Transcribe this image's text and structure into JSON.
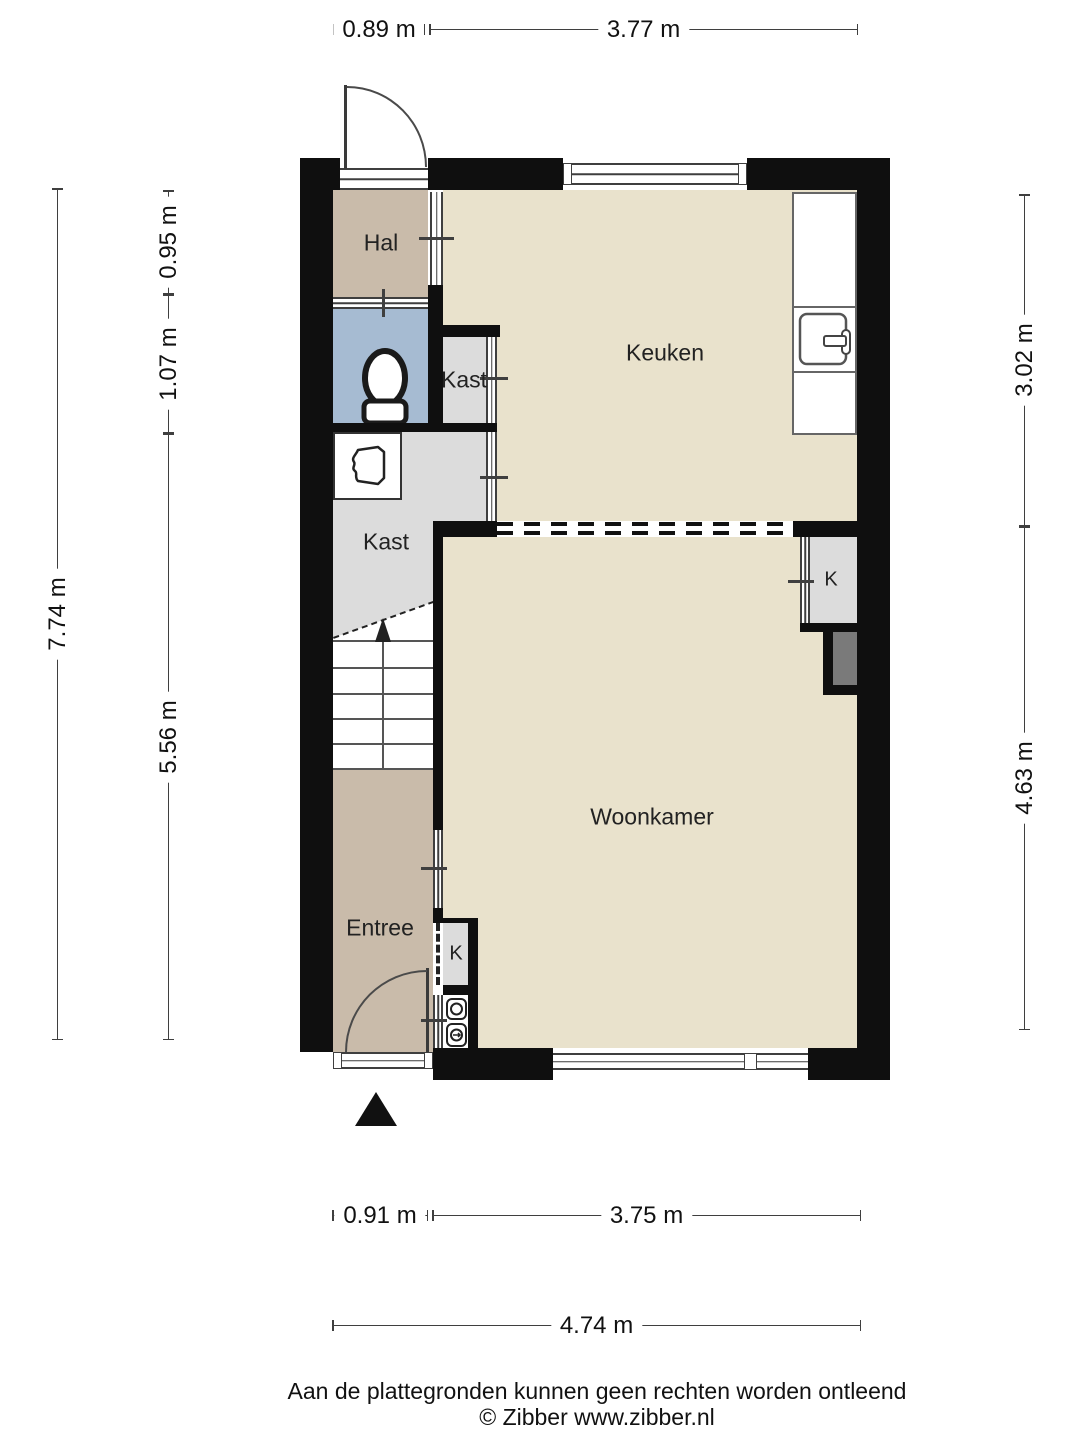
{
  "palette": {
    "wall": "#0f0f0f",
    "floor_main": "#e9e2cc",
    "floor_hall": "#c9bbaa",
    "floor_entree": "#c9bbaa",
    "floor_toilet": "#a6bbd2",
    "floor_closet": "#dcdcdc",
    "chimney": "#7a7a7a",
    "dim_line": "#3f3f3f",
    "text": "#1c1c1c"
  },
  "rooms": {
    "hal": "Hal",
    "keuken": "Keuken",
    "kast_small": "Kast",
    "kast_large": "Kast",
    "woonkamer": "Woonkamer",
    "entree": "Entree",
    "closet_top_right": "K",
    "closet_bottom": "K"
  },
  "dimensions": {
    "top": [
      "0.89 m",
      "3.77 m"
    ],
    "left_outer": "7.74 m",
    "left_inner": [
      "0.95 m",
      "1.07 m",
      "5.56 m"
    ],
    "right": [
      "3.02 m",
      "4.63 m"
    ],
    "bottom": [
      "0.91 m",
      "3.75 m"
    ],
    "bottom_total": "4.74 m"
  },
  "icons": {
    "toilet": "toilet-icon",
    "boiler": "boiler-icon",
    "sink": "sink-icon",
    "meters": "meter-icons",
    "stairs_arrow": "stairs-up-arrow",
    "entrance_arrow": "entrance-arrow"
  },
  "footer": {
    "line1": "Aan de plattegronden kunnen geen rechten worden ontleend",
    "line2": "© Zibber www.zibber.nl"
  }
}
